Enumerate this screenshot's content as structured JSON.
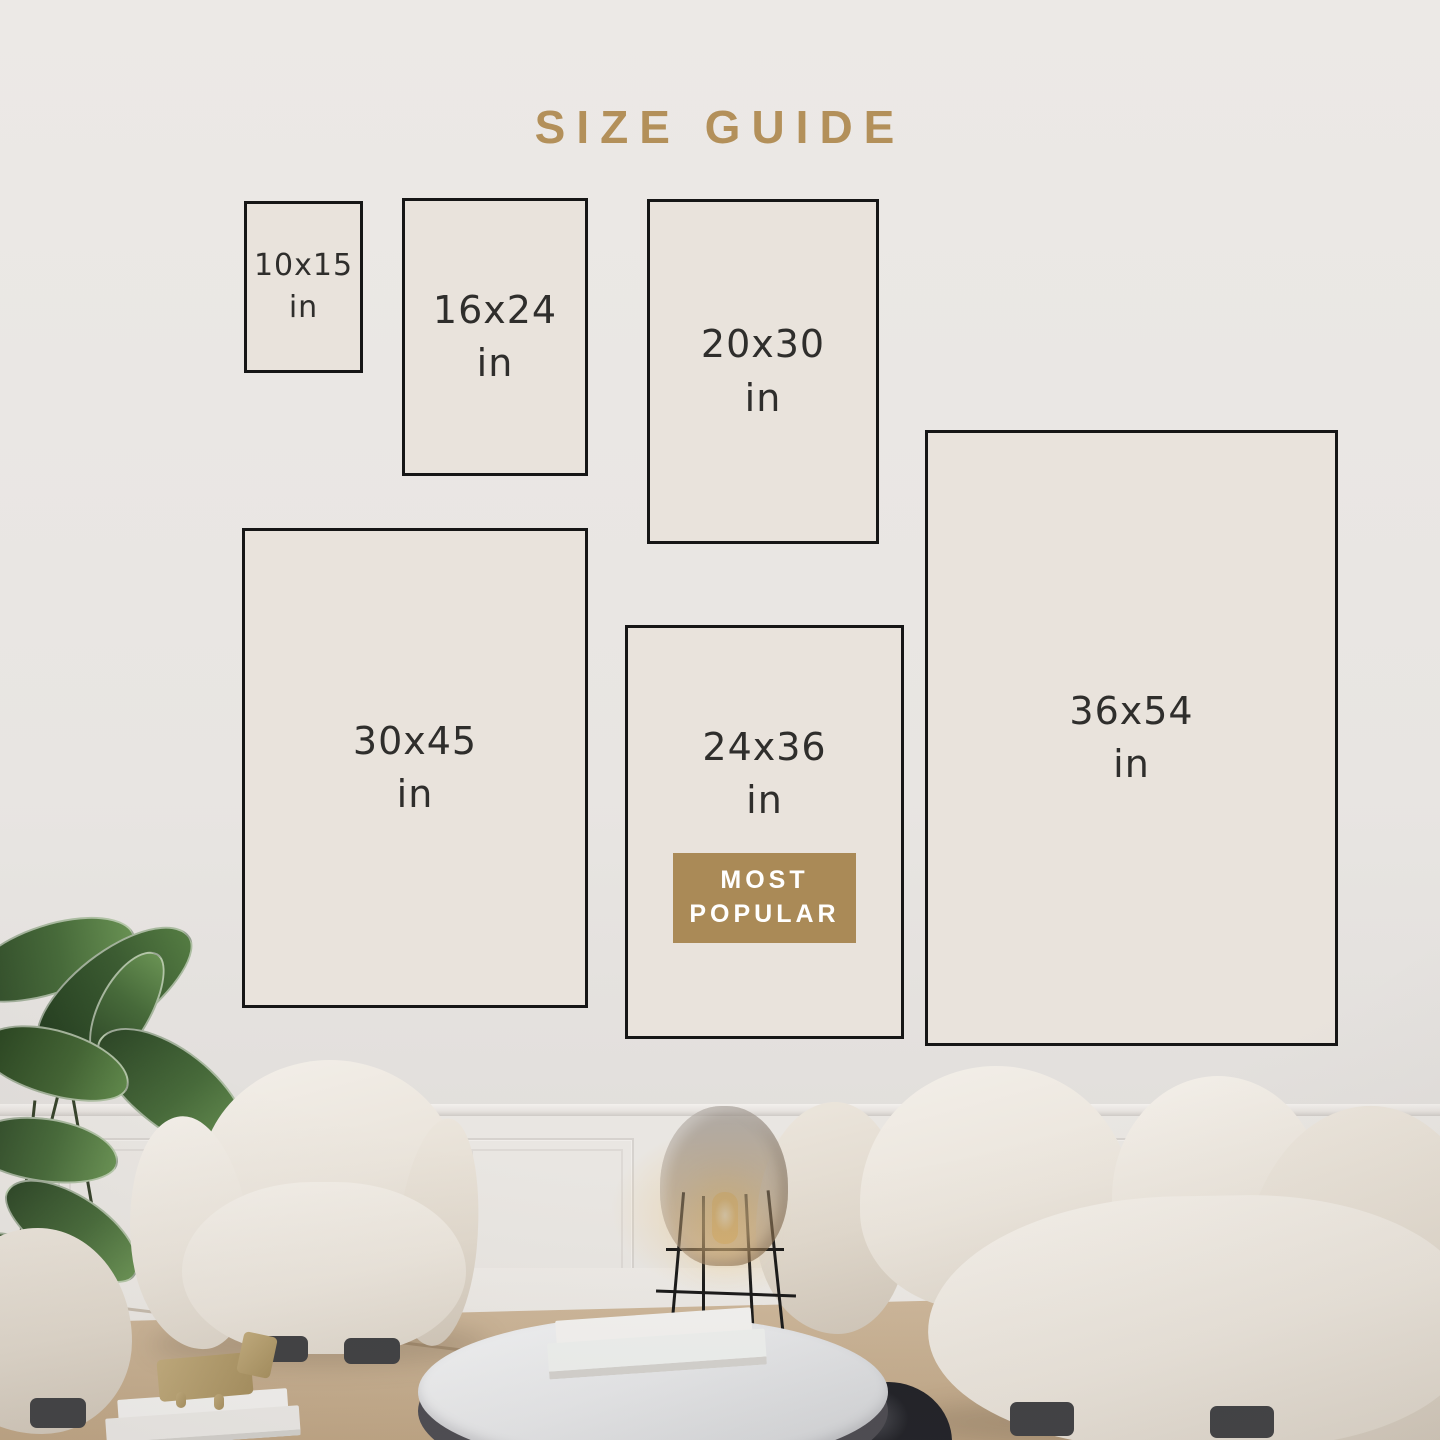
{
  "title": "SIZE GUIDE",
  "unit_word": "in",
  "sizes": [
    {
      "dimensions": "10x15",
      "unit": "in"
    },
    {
      "dimensions": "16x24",
      "unit": "in"
    },
    {
      "dimensions": "20x30",
      "unit": "in"
    },
    {
      "dimensions": "30x45",
      "unit": "in"
    },
    {
      "dimensions": "24x36",
      "unit": "in",
      "badge": "MOST POPULAR"
    },
    {
      "dimensions": "36x54",
      "unit": "in"
    }
  ],
  "badge": {
    "line1": "MOST",
    "line2": "POPULAR"
  },
  "colors": {
    "accent_gold": "#b3905a",
    "badge_gold": "#aa8a57",
    "box_fill": "#e9e3dc",
    "box_border": "#161616",
    "label_text": "#2f2e2c",
    "wall": "#e8e5e2",
    "rug": "#c6ae8f"
  }
}
